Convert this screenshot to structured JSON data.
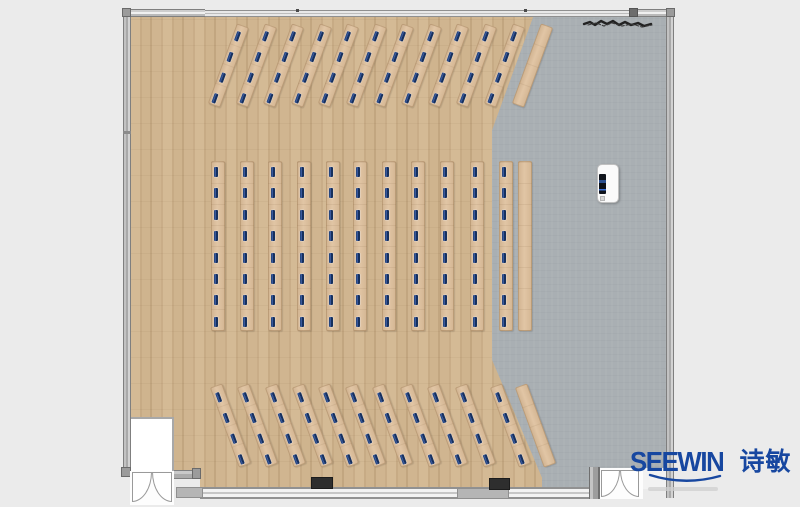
{
  "meta": {
    "view": "top-down floor plan rendering",
    "room_type": "training / lecture room furniture layout"
  },
  "brand": {
    "name": "SEEWIN",
    "chinese": "诗敏",
    "color": "#1747a0"
  },
  "colors": {
    "exterior": "#ebebeb",
    "wood_floor": "#cdb28e",
    "gray_floor": "#a9afb3",
    "desk": "#debf9b",
    "seat_marker": "#16305e",
    "wall": "#b3b3b3"
  },
  "capacity": {
    "total_seats": 176,
    "seated_desks": 33,
    "plain_side_tables": 3
  },
  "floorplan": {
    "sections": [
      {
        "id": "top-angled-rows",
        "label": "angled desk rows (top)",
        "rotation_deg": 20,
        "desk_width": 13,
        "desk_length": 85,
        "center_y": 65,
        "seats_per_desk": 4,
        "seat_start": 6,
        "seat_step": 22,
        "marked_desks": 11,
        "centers_x": [
          228,
          256,
          283,
          311,
          338,
          366,
          393,
          421,
          448,
          476,
          504,
          532
        ]
      },
      {
        "id": "middle-columns",
        "label": "straight desk columns (middle)",
        "rotation_deg": 0,
        "desk_width": 14,
        "desk_length": 170,
        "center_y": 246,
        "seats_per_desk": 8,
        "seat_start": 5,
        "seat_step": 21.4,
        "marked_desks": 11,
        "centers_x": [
          218,
          247,
          275,
          304,
          333,
          360,
          389,
          418,
          447,
          477,
          506,
          525
        ]
      },
      {
        "id": "bottom-angled-rows",
        "label": "angled desk rows (bottom)",
        "rotation_deg": -20,
        "desk_width": 13,
        "desk_length": 85,
        "center_y": 425,
        "seats_per_desk": 4,
        "seat_start": 6,
        "seat_step": 22,
        "marked_desks": 11,
        "centers_x": [
          230,
          257,
          285,
          312,
          338,
          365,
          392,
          420,
          447,
          475,
          510,
          535
        ]
      }
    ],
    "objects": [
      {
        "id": "podium",
        "label": "presenter podium with screen"
      },
      {
        "id": "door-bottom-left",
        "label": "double swing door"
      },
      {
        "id": "door-bottom-right",
        "label": "double swing door"
      },
      {
        "id": "sketch-mark",
        "label": "hand-drawn scribble annotation, top right"
      }
    ]
  }
}
